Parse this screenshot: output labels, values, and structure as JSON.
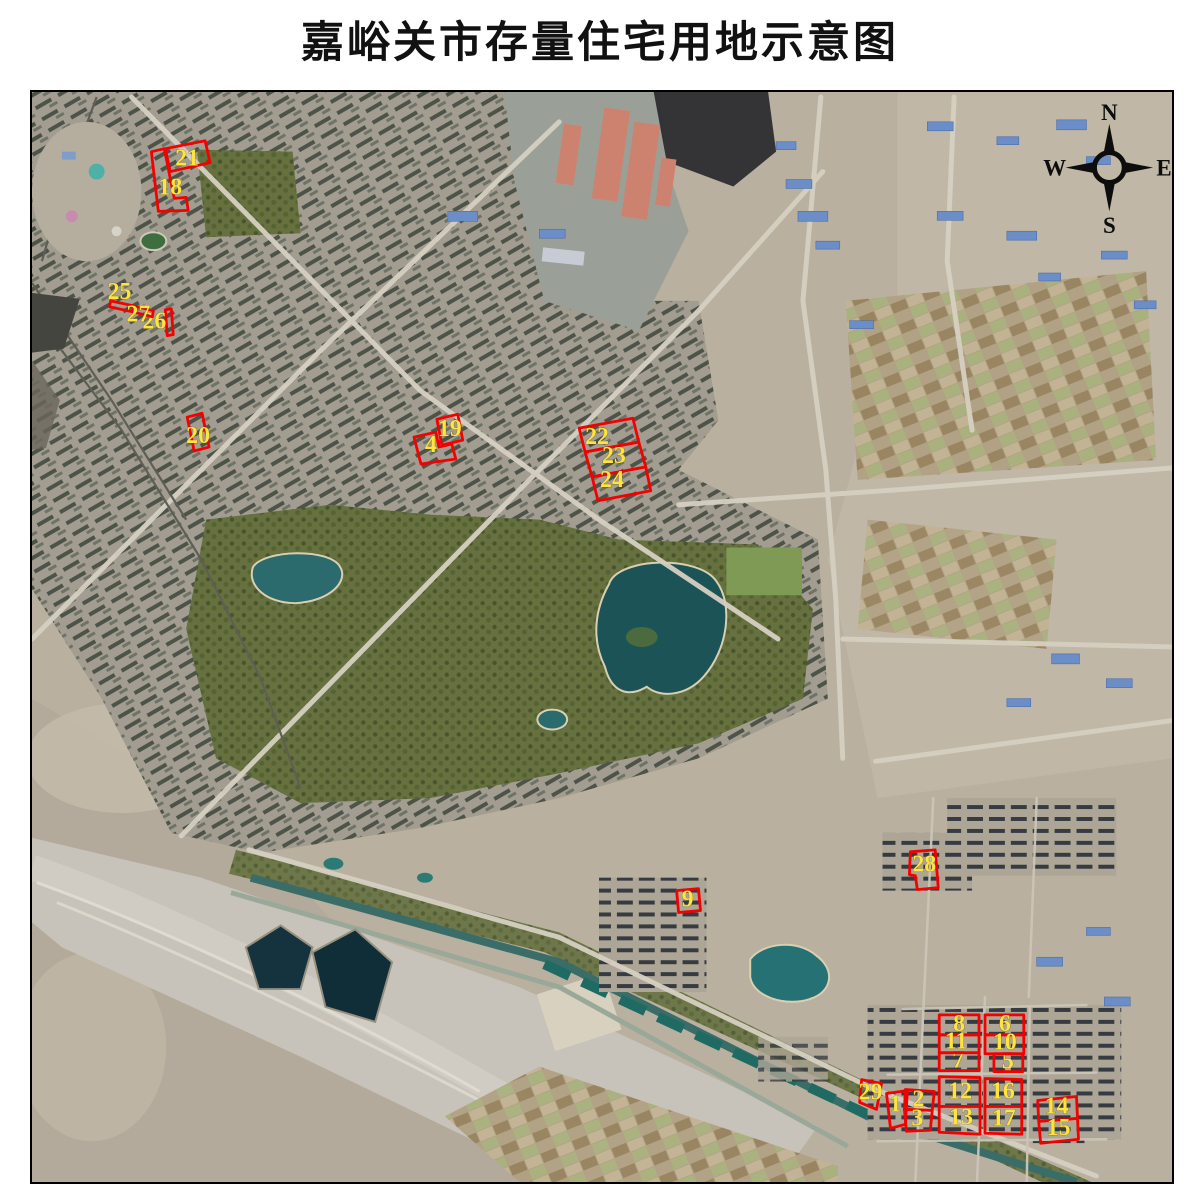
{
  "title": "嘉峪关市存量住宅用地示意图",
  "compass": {
    "north": "N",
    "east": "E",
    "south": "S",
    "west": "W"
  },
  "map": {
    "type": "satellite-schematic",
    "parcel_outline_color": "#f40000",
    "parcel_label_color": "#ffe43c",
    "parcels": [
      {
        "label": "1",
        "points": "889,1097 910,1094 908,1128 893,1132",
        "lx": 898,
        "ly": 1115
      },
      {
        "label": "2",
        "points": "908,1093 937,1095 935,1114 907,1113",
        "lx": 921,
        "ly": 1110
      },
      {
        "label": "3",
        "points": "907,1113 935,1114 933,1134 909,1135",
        "lx": 920,
        "ly": 1129
      },
      {
        "label": "4",
        "points": "414,437 436,432 439,447 452,444 456,459 421,464",
        "lx": 431,
        "ly": 452
      },
      {
        "label": "5",
        "points": "997,1057 1026,1057 1026,1075 997,1075",
        "lx": 1011,
        "ly": 1072
      },
      {
        "label": "6",
        "points": "988,1018 1027,1018 1027,1038 988,1038",
        "lx": 1008,
        "ly": 1034
      },
      {
        "label": "7",
        "points": "942,1056 982,1056 982,1074 942,1074",
        "lx": 961,
        "ly": 1071
      },
      {
        "label": "8",
        "points": "942,1018 982,1018 982,1038 942,1038",
        "lx": 962,
        "ly": 1034
      },
      {
        "label": "9",
        "points": "678,893 700,891 702,913 680,915",
        "lx": 689,
        "ly": 909
      },
      {
        "label": "10",
        "points": "988,1038 1027,1038 1027,1057 988,1057",
        "lx": 1008,
        "ly": 1053
      },
      {
        "label": "11",
        "points": "942,1038 982,1038 982,1056 942,1056",
        "lx": 959,
        "ly": 1052
      },
      {
        "label": "12",
        "points": "942,1080 983,1081 983,1110 942,1110",
        "lx": 963,
        "ly": 1102
      },
      {
        "label": "13",
        "points": "942,1110 983,1110 983,1138 942,1136",
        "lx": 964,
        "ly": 1128
      },
      {
        "label": "14",
        "points": "1041,1104 1080,1100 1081,1122 1042,1125",
        "lx": 1060,
        "ly": 1117
      },
      {
        "label": "15",
        "points": "1042,1125 1081,1122 1082,1143 1044,1147",
        "lx": 1062,
        "ly": 1139
      },
      {
        "label": "16",
        "points": "988,1082 1025,1083 1025,1110 988,1110",
        "lx": 1006,
        "ly": 1102
      },
      {
        "label": "17",
        "points": "988,1110 1025,1110 1025,1138 988,1137",
        "lx": 1007,
        "ly": 1129
      },
      {
        "label": "18",
        "points": "150,150 163,147 173,197 185,196 187,209 157,210",
        "lx": 169,
        "ly": 193
      },
      {
        "label": "19",
        "points": "437,419 458,414 463,440 442,445",
        "lx": 450,
        "ly": 436
      },
      {
        "label": "20",
        "points": "186,417 201,413 208,447 193,451",
        "lx": 197,
        "ly": 443
      },
      {
        "label": "21",
        "points": "164,147 204,139 209,161 169,170",
        "lx": 186,
        "ly": 164
      },
      {
        "label": "22",
        "points": "580,428 634,418 640,442 586,452",
        "lx": 598,
        "ly": 444
      },
      {
        "label": "23",
        "points": "586,452 640,442 647,467 593,477",
        "lx": 615,
        "ly": 463
      },
      {
        "label": "24",
        "points": "593,477 647,467 652,491 599,501",
        "lx": 613,
        "ly": 487
      },
      {
        "label": "25",
        "points": "109,300 132,305 131,311 108,306",
        "lx": 118,
        "ly": 298
      },
      {
        "label": "26",
        "points": "164,309 170,308 172,334 166,335",
        "lx": 153,
        "ly": 328
      },
      {
        "label": "27",
        "points": "132,305 152,310 151,316 131,311",
        "lx": 137,
        "ly": 321
      },
      {
        "label": "28",
        "points": "913,854 938,852 941,890 920,892 918,878 912,877",
        "lx": 927,
        "ly": 874
      },
      {
        "label": "29",
        "points": "864,1083 884,1087 879,1113 862,1106",
        "lx": 873,
        "ly": 1103
      }
    ]
  }
}
